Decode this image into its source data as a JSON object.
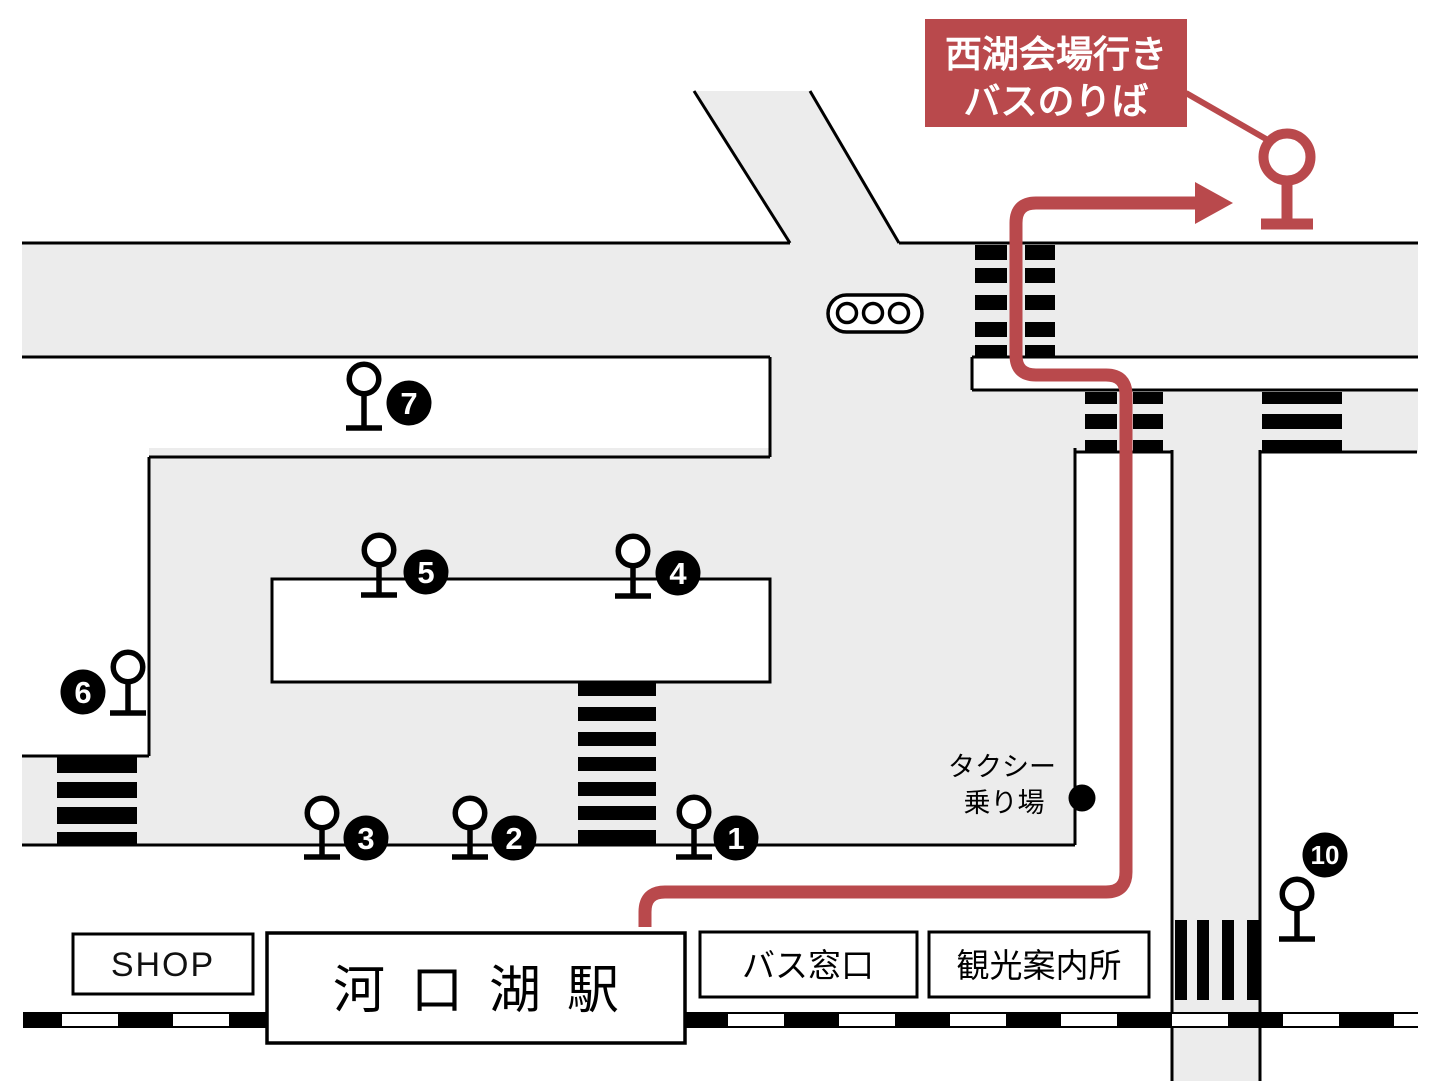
{
  "banner": {
    "line1": "西湖会場行き",
    "line2": "バスのりば"
  },
  "taxi": {
    "line1": "タクシー",
    "line2": "乗り場"
  },
  "buildings": {
    "shop": "SHOP",
    "station": "河口湖駅",
    "bus_counter": "バス窓口",
    "tourist_info": "観光案内所"
  },
  "bus_stops": [
    {
      "number": "1"
    },
    {
      "number": "2"
    },
    {
      "number": "3"
    },
    {
      "number": "4"
    },
    {
      "number": "5"
    },
    {
      "number": "6"
    },
    {
      "number": "7"
    },
    {
      "number": "10"
    }
  ],
  "colors": {
    "route_red": "#b9494c",
    "road_gray": "#ececec",
    "outline_black": "#000000",
    "background": "#ffffff"
  }
}
